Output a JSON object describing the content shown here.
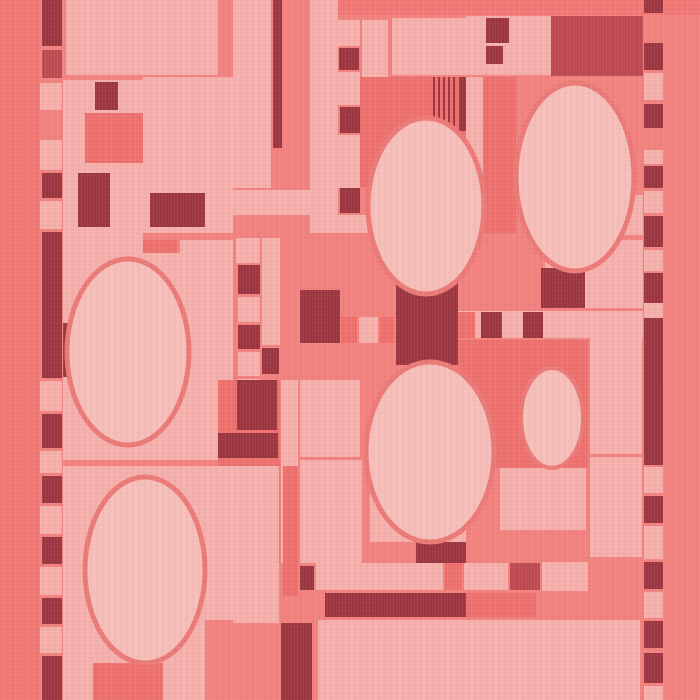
{
  "artwork": {
    "label": "Abstract rectilinear textile pattern with ovals, coral pink and maroon",
    "canvas": {
      "width": 700,
      "height": 700
    }
  },
  "palette": {
    "bg": "#f5837f",
    "bgDeep": "#f47976",
    "light": "#f8b2ae",
    "lighter": "#f9c0bb",
    "med": "#f0716e",
    "dark": "#9d3641",
    "darkRed": "#c14a52",
    "stroke": "#ee7b78"
  },
  "shapes": [
    {
      "t": "rect",
      "n": "background",
      "x": 0,
      "y": 0,
      "w": 700,
      "h": 700,
      "f": "bg"
    },
    {
      "t": "rect",
      "n": "left-border-band",
      "x": 0,
      "y": 0,
      "w": 40,
      "h": 700,
      "f": "bgDeep"
    },
    {
      "t": "rect",
      "n": "top-border-band",
      "x": 320,
      "y": 0,
      "w": 380,
      "h": 15,
      "f": "bgDeep"
    },
    {
      "t": "rect",
      "x": 42,
      "y": 0,
      "w": 20,
      "h": 46,
      "f": "dark"
    },
    {
      "t": "rect",
      "x": 42,
      "y": 50,
      "w": 20,
      "h": 28,
      "f": "darkRed"
    },
    {
      "t": "rect",
      "x": 40,
      "y": 83,
      "w": 22,
      "h": 27,
      "f": "light"
    },
    {
      "t": "rect",
      "x": 40,
      "y": 140,
      "w": 22,
      "h": 30,
      "f": "light"
    },
    {
      "t": "rect",
      "x": 42,
      "y": 173,
      "w": 20,
      "h": 25,
      "f": "dark"
    },
    {
      "t": "rect",
      "x": 40,
      "y": 201,
      "w": 22,
      "h": 28,
      "f": "light"
    },
    {
      "t": "rect",
      "x": 42,
      "y": 232,
      "w": 20,
      "h": 146,
      "f": "dark"
    },
    {
      "t": "rect",
      "x": 40,
      "y": 381,
      "w": 22,
      "h": 30,
      "f": "light"
    },
    {
      "t": "rect",
      "x": 42,
      "y": 414,
      "w": 20,
      "h": 34,
      "f": "dark"
    },
    {
      "t": "rect",
      "x": 40,
      "y": 451,
      "w": 22,
      "h": 22,
      "f": "light"
    },
    {
      "t": "rect",
      "x": 42,
      "y": 476,
      "w": 20,
      "h": 27,
      "f": "dark"
    },
    {
      "t": "rect",
      "x": 40,
      "y": 506,
      "w": 22,
      "h": 28,
      "f": "light"
    },
    {
      "t": "rect",
      "x": 42,
      "y": 537,
      "w": 20,
      "h": 27,
      "f": "dark"
    },
    {
      "t": "rect",
      "x": 40,
      "y": 567,
      "w": 22,
      "h": 28,
      "f": "light"
    },
    {
      "t": "rect",
      "x": 42,
      "y": 598,
      "w": 20,
      "h": 26,
      "f": "dark"
    },
    {
      "t": "rect",
      "x": 40,
      "y": 627,
      "w": 22,
      "h": 26,
      "f": "light"
    },
    {
      "t": "rect",
      "x": 42,
      "y": 656,
      "w": 20,
      "h": 44,
      "f": "dark"
    },
    {
      "t": "rect",
      "x": 66,
      "y": 0,
      "w": 152,
      "h": 75,
      "f": "light"
    },
    {
      "t": "rect",
      "x": 63,
      "y": 80,
      "w": 80,
      "h": 173,
      "f": "light"
    },
    {
      "t": "rect",
      "x": 95,
      "y": 82,
      "w": 23,
      "h": 28,
      "f": "dark"
    },
    {
      "t": "rect",
      "x": 85,
      "y": 113,
      "w": 58,
      "h": 50,
      "f": "med"
    },
    {
      "t": "rect",
      "x": 78,
      "y": 173,
      "w": 32,
      "h": 54,
      "f": "dark"
    },
    {
      "t": "rect",
      "x": 143,
      "y": 77,
      "w": 90,
      "h": 156,
      "f": "light"
    },
    {
      "t": "rect",
      "x": 150,
      "y": 193,
      "w": 55,
      "h": 34,
      "f": "dark"
    },
    {
      "t": "rect",
      "x": 63,
      "y": 233,
      "w": 80,
      "h": 18,
      "f": "light"
    },
    {
      "t": "rect",
      "x": 143,
      "y": 240,
      "w": 34,
      "h": 62,
      "f": "med"
    },
    {
      "t": "rect",
      "x": 180,
      "y": 240,
      "w": 53,
      "h": 62,
      "f": "light"
    },
    {
      "t": "rect",
      "x": 63,
      "y": 253,
      "w": 170,
      "h": 207,
      "f": "light"
    },
    {
      "t": "rect",
      "x": 63,
      "y": 323,
      "w": 14,
      "h": 54,
      "f": "dark"
    },
    {
      "t": "rect",
      "x": 233,
      "y": 0,
      "w": 38,
      "h": 188,
      "f": "light"
    },
    {
      "t": "rect",
      "x": 273,
      "y": 0,
      "w": 9,
      "h": 148,
      "f": "dark"
    },
    {
      "t": "rect",
      "x": 310,
      "y": 0,
      "w": 28,
      "h": 233,
      "f": "light"
    },
    {
      "t": "rect",
      "x": 338,
      "y": 20,
      "w": 22,
      "h": 26,
      "f": "light"
    },
    {
      "t": "rect",
      "x": 339,
      "y": 48,
      "w": 20,
      "h": 22,
      "f": "dark"
    },
    {
      "t": "rect",
      "x": 338,
      "y": 72,
      "w": 22,
      "h": 33,
      "f": "light"
    },
    {
      "t": "rect",
      "x": 340,
      "y": 107,
      "w": 20,
      "h": 26,
      "f": "dark"
    },
    {
      "t": "rect",
      "x": 338,
      "y": 135,
      "w": 22,
      "h": 53,
      "f": "light"
    },
    {
      "t": "rect",
      "x": 340,
      "y": 188,
      "w": 20,
      "h": 25,
      "f": "dark"
    },
    {
      "t": "rect",
      "x": 338,
      "y": 215,
      "w": 22,
      "h": 18,
      "f": "light"
    },
    {
      "t": "rect",
      "x": 233,
      "y": 190,
      "w": 104,
      "h": 25,
      "f": "light"
    },
    {
      "t": "rect",
      "x": 310,
      "y": 215,
      "w": 156,
      "h": 18,
      "f": "light"
    },
    {
      "t": "rect",
      "x": 362,
      "y": 20,
      "w": 26,
      "h": 57,
      "f": "light"
    },
    {
      "t": "rect",
      "x": 392,
      "y": 18,
      "w": 74,
      "h": 57,
      "f": "light"
    },
    {
      "t": "rect",
      "x": 360,
      "y": 77,
      "w": 112,
      "h": 110,
      "f": "med"
    },
    {
      "t": "rect",
      "x": 433,
      "y": 77,
      "w": 2,
      "h": 55,
      "f": "dark"
    },
    {
      "t": "rect",
      "x": 438,
      "y": 77,
      "w": 2,
      "h": 55,
      "f": "dark"
    },
    {
      "t": "rect",
      "x": 443,
      "y": 77,
      "w": 2,
      "h": 55,
      "f": "dark"
    },
    {
      "t": "rect",
      "x": 448,
      "y": 77,
      "w": 2,
      "h": 55,
      "f": "dark"
    },
    {
      "t": "rect",
      "x": 453,
      "y": 77,
      "w": 2,
      "h": 55,
      "f": "dark"
    },
    {
      "t": "rect",
      "x": 459,
      "y": 77,
      "w": 10,
      "h": 54,
      "f": "dark"
    },
    {
      "t": "rect",
      "x": 466,
      "y": 16,
      "w": 85,
      "h": 59,
      "f": "light"
    },
    {
      "t": "rect",
      "x": 486,
      "y": 18,
      "w": 23,
      "h": 25,
      "f": "dark"
    },
    {
      "t": "rect",
      "x": 486,
      "y": 46,
      "w": 17,
      "h": 18,
      "f": "dark"
    },
    {
      "t": "rect",
      "n": "large-dark-red-block",
      "x": 551,
      "y": 16,
      "w": 92,
      "h": 60,
      "f": "darkRed"
    },
    {
      "t": "rect",
      "x": 466,
      "y": 77,
      "w": 17,
      "h": 156,
      "f": "light"
    },
    {
      "t": "rect",
      "x": 483,
      "y": 77,
      "w": 33,
      "h": 156,
      "f": "med"
    },
    {
      "t": "rect",
      "x": 592,
      "y": 195,
      "w": 51,
      "h": 40,
      "f": "light"
    },
    {
      "t": "rect",
      "x": 545,
      "y": 240,
      "w": 98,
      "h": 68,
      "f": "light"
    },
    {
      "t": "rect",
      "x": 541,
      "y": 268,
      "w": 44,
      "h": 40,
      "f": "dark"
    },
    {
      "t": "rect",
      "x": 644,
      "y": 0,
      "w": 19,
      "h": 13,
      "f": "dark"
    },
    {
      "t": "rect",
      "x": 644,
      "y": 43,
      "w": 19,
      "h": 27,
      "f": "dark"
    },
    {
      "t": "rect",
      "x": 644,
      "y": 73,
      "w": 19,
      "h": 27,
      "f": "light"
    },
    {
      "t": "rect",
      "x": 644,
      "y": 104,
      "w": 19,
      "h": 24,
      "f": "dark"
    },
    {
      "t": "rect",
      "x": 644,
      "y": 150,
      "w": 19,
      "h": 14,
      "f": "light"
    },
    {
      "t": "rect",
      "x": 644,
      "y": 166,
      "w": 19,
      "h": 22,
      "f": "dark"
    },
    {
      "t": "rect",
      "x": 644,
      "y": 191,
      "w": 19,
      "h": 22,
      "f": "light"
    },
    {
      "t": "rect",
      "x": 644,
      "y": 216,
      "w": 19,
      "h": 31,
      "f": "dark"
    },
    {
      "t": "rect",
      "x": 644,
      "y": 250,
      "w": 19,
      "h": 21,
      "f": "light"
    },
    {
      "t": "rect",
      "x": 644,
      "y": 273,
      "w": 19,
      "h": 30,
      "f": "dark"
    },
    {
      "t": "rect",
      "x": 644,
      "y": 303,
      "w": 19,
      "h": 15,
      "f": "light"
    },
    {
      "t": "rect",
      "x": 644,
      "y": 318,
      "w": 19,
      "h": 147,
      "f": "dark"
    },
    {
      "t": "rect",
      "x": 644,
      "y": 467,
      "w": 19,
      "h": 26,
      "f": "light"
    },
    {
      "t": "rect",
      "x": 644,
      "y": 496,
      "w": 19,
      "h": 27,
      "f": "dark"
    },
    {
      "t": "rect",
      "x": 644,
      "y": 526,
      "w": 19,
      "h": 33,
      "f": "light"
    },
    {
      "t": "rect",
      "x": 644,
      "y": 562,
      "w": 19,
      "h": 27,
      "f": "dark"
    },
    {
      "t": "rect",
      "x": 644,
      "y": 592,
      "w": 19,
      "h": 26,
      "f": "light"
    },
    {
      "t": "rect",
      "x": 644,
      "y": 621,
      "w": 19,
      "h": 27,
      "f": "dark"
    },
    {
      "t": "rect",
      "x": 644,
      "y": 653,
      "w": 19,
      "h": 30,
      "f": "dark"
    },
    {
      "t": "rect",
      "x": 644,
      "y": 686,
      "w": 19,
      "h": 14,
      "f": "light"
    },
    {
      "t": "rect",
      "x": 236,
      "y": 238,
      "w": 24,
      "h": 25,
      "f": "light"
    },
    {
      "t": "rect",
      "x": 262,
      "y": 238,
      "w": 18,
      "h": 107,
      "f": "light"
    },
    {
      "t": "rect",
      "x": 238,
      "y": 265,
      "w": 22,
      "h": 29,
      "f": "dark"
    },
    {
      "t": "rect",
      "x": 238,
      "y": 297,
      "w": 22,
      "h": 25,
      "f": "light"
    },
    {
      "t": "rect",
      "x": 238,
      "y": 325,
      "w": 22,
      "h": 24,
      "f": "dark"
    },
    {
      "t": "rect",
      "x": 238,
      "y": 352,
      "w": 22,
      "h": 24,
      "f": "light"
    },
    {
      "t": "rect",
      "x": 262,
      "y": 348,
      "w": 17,
      "h": 26,
      "f": "dark"
    },
    {
      "t": "rect",
      "x": 238,
      "y": 379,
      "w": 22,
      "h": 28,
      "f": "light"
    },
    {
      "t": "rect",
      "x": 238,
      "y": 440,
      "w": 26,
      "h": 26,
      "f": "dark"
    },
    {
      "t": "rect",
      "x": 300,
      "y": 290,
      "w": 40,
      "h": 53,
      "f": "dark"
    },
    {
      "t": "rect",
      "x": 341,
      "y": 317,
      "w": 16,
      "h": 26,
      "f": "med"
    },
    {
      "t": "rect",
      "x": 359,
      "y": 317,
      "w": 19,
      "h": 26,
      "f": "light"
    },
    {
      "t": "rect",
      "x": 380,
      "y": 317,
      "w": 14,
      "h": 26,
      "f": "med"
    },
    {
      "t": "rect",
      "x": 446,
      "y": 317,
      "w": 12,
      "h": 26,
      "f": "dark"
    },
    {
      "t": "rect",
      "n": "hourglass-dark-block",
      "x": 396,
      "y": 270,
      "w": 62,
      "h": 95,
      "f": "dark"
    },
    {
      "t": "rect",
      "x": 458,
      "y": 311,
      "w": 185,
      "h": 27,
      "f": "light"
    },
    {
      "t": "rect",
      "x": 458,
      "y": 312,
      "w": 17,
      "h": 26,
      "f": "med"
    },
    {
      "t": "rect",
      "x": 481,
      "y": 312,
      "w": 21,
      "h": 26,
      "f": "dark"
    },
    {
      "t": "rect",
      "x": 523,
      "y": 312,
      "w": 20,
      "h": 26,
      "f": "dark"
    },
    {
      "t": "rect",
      "x": 458,
      "y": 340,
      "w": 130,
      "h": 128,
      "f": "med"
    },
    {
      "t": "rect",
      "x": 590,
      "y": 338,
      "w": 52,
      "h": 116,
      "f": "light"
    },
    {
      "t": "rect",
      "x": 590,
      "y": 457,
      "w": 52,
      "h": 100,
      "f": "light"
    },
    {
      "t": "rect",
      "x": 500,
      "y": 468,
      "w": 86,
      "h": 62,
      "f": "light"
    },
    {
      "t": "rect",
      "x": 218,
      "y": 380,
      "w": 62,
      "h": 183,
      "f": "med"
    },
    {
      "t": "rect",
      "x": 237,
      "y": 380,
      "w": 40,
      "h": 50,
      "f": "dark"
    },
    {
      "t": "rect",
      "x": 218,
      "y": 433,
      "w": 60,
      "h": 25,
      "f": "dark"
    },
    {
      "t": "rect",
      "x": 281,
      "y": 380,
      "w": 17,
      "h": 183,
      "f": "light"
    },
    {
      "t": "rect",
      "x": 300,
      "y": 380,
      "w": 60,
      "h": 77,
      "f": "light"
    },
    {
      "t": "rect",
      "x": 300,
      "y": 460,
      "w": 58,
      "h": 103,
      "f": "light"
    },
    {
      "t": "rect",
      "x": 63,
      "y": 466,
      "w": 142,
      "h": 234,
      "f": "light"
    },
    {
      "t": "rect",
      "x": 205,
      "y": 466,
      "w": 28,
      "h": 154,
      "f": "light"
    },
    {
      "t": "rect",
      "x": 93,
      "y": 663,
      "w": 70,
      "h": 37,
      "f": "med"
    },
    {
      "t": "rect",
      "x": 163,
      "y": 663,
      "w": 40,
      "h": 37,
      "f": "light"
    },
    {
      "t": "rect",
      "x": 233,
      "y": 466,
      "w": 46,
      "h": 157,
      "f": "light"
    },
    {
      "t": "rect",
      "x": 283,
      "y": 466,
      "w": 15,
      "h": 130,
      "f": "med"
    },
    {
      "t": "rect",
      "x": 318,
      "y": 460,
      "w": 44,
      "h": 103,
      "f": "light"
    },
    {
      "t": "rect",
      "x": 370,
      "y": 466,
      "w": 96,
      "h": 76,
      "f": "light"
    },
    {
      "t": "rect",
      "x": 416,
      "y": 542,
      "w": 50,
      "h": 21,
      "f": "dark"
    },
    {
      "t": "rect",
      "x": 300,
      "y": 566,
      "w": 14,
      "h": 24,
      "f": "dark"
    },
    {
      "t": "rect",
      "x": 316,
      "y": 563,
      "w": 127,
      "h": 27,
      "f": "light"
    },
    {
      "t": "rect",
      "x": 445,
      "y": 563,
      "w": 17,
      "h": 27,
      "f": "med"
    },
    {
      "t": "rect",
      "x": 464,
      "y": 563,
      "w": 44,
      "h": 27,
      "f": "light"
    },
    {
      "t": "rect",
      "x": 510,
      "y": 563,
      "w": 30,
      "h": 27,
      "f": "darkRed"
    },
    {
      "t": "rect",
      "x": 542,
      "y": 562,
      "w": 46,
      "h": 29,
      "f": "light"
    },
    {
      "t": "rect",
      "n": "long-dark-bar",
      "x": 325,
      "y": 593,
      "w": 141,
      "h": 24,
      "f": "dark"
    },
    {
      "t": "rect",
      "x": 466,
      "y": 593,
      "w": 70,
      "h": 24,
      "f": "med"
    },
    {
      "t": "rect",
      "x": 281,
      "y": 623,
      "w": 31,
      "h": 77,
      "f": "dark"
    },
    {
      "t": "rect",
      "x": 318,
      "y": 620,
      "w": 148,
      "h": 80,
      "f": "light"
    },
    {
      "t": "rect",
      "x": 466,
      "y": 620,
      "w": 174,
      "h": 80,
      "f": "light"
    },
    {
      "t": "ellipse",
      "n": "oval-top-center",
      "cx": 426,
      "cy": 206,
      "rx": 58,
      "ry": 88,
      "f": "lighter",
      "s": "stroke",
      "sw": 5
    },
    {
      "t": "ellipse",
      "n": "oval-top-right",
      "cx": 575,
      "cy": 177,
      "rx": 59,
      "ry": 94,
      "f": "lighter",
      "s": "stroke",
      "sw": 5
    },
    {
      "t": "ellipse",
      "n": "oval-mid-left",
      "cx": 128,
      "cy": 352,
      "rx": 61,
      "ry": 93,
      "f": "lighter",
      "s": "stroke",
      "sw": 5
    },
    {
      "t": "ellipse",
      "n": "oval-mid-center",
      "cx": 430,
      "cy": 452,
      "rx": 64,
      "ry": 90,
      "f": "lighter",
      "s": "stroke",
      "sw": 5
    },
    {
      "t": "ellipse",
      "n": "oval-small-right",
      "cx": 552,
      "cy": 418,
      "rx": 31,
      "ry": 50,
      "f": "lighter",
      "s": "stroke",
      "sw": 4
    },
    {
      "t": "ellipse",
      "n": "oval-bottom-left",
      "cx": 145,
      "cy": 570,
      "rx": 60,
      "ry": 93,
      "f": "lighter",
      "s": "stroke",
      "sw": 5
    }
  ]
}
